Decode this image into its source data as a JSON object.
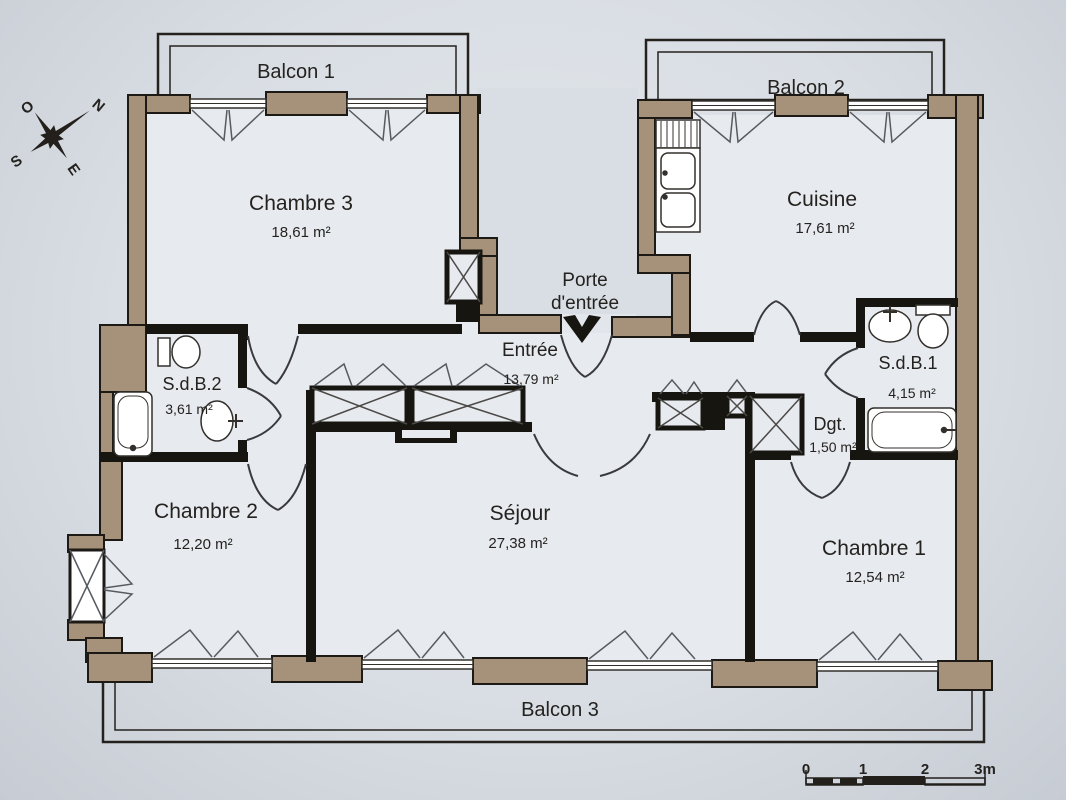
{
  "plan": {
    "balconies": {
      "b1": "Balcon 1",
      "b2": "Balcon 2",
      "b3": "Balcon 3"
    },
    "rooms": {
      "chambre3": {
        "name": "Chambre 3",
        "area": "18,61 m²"
      },
      "cuisine": {
        "name": "Cuisine",
        "area": "17,61 m²"
      },
      "entree": {
        "name": "Entrée",
        "area": "13,79 m²"
      },
      "sdb2": {
        "name": "S.d.B.2",
        "area": "3,61 m²"
      },
      "sdb1": {
        "name": "S.d.B.1",
        "area": "4,15 m²"
      },
      "dgt": {
        "name": "Dgt.",
        "area": "1,50 m²"
      },
      "chambre2": {
        "name": "Chambre 2",
        "area": "12,20 m²"
      },
      "sejour": {
        "name": "Séjour",
        "area": "27,38 m²"
      },
      "chambre1": {
        "name": "Chambre 1",
        "area": "12,54 m²"
      }
    },
    "entrance": {
      "line1": "Porte",
      "line2": "d'entrée"
    },
    "compass": {
      "n": "N",
      "s": "S",
      "e": "E",
      "o": "O"
    },
    "scale_bar": {
      "t0": "0",
      "t1": "1",
      "t2": "2",
      "t3": "3m"
    },
    "colors": {
      "wall": "#a6917a",
      "line": "#1d1a16",
      "paper": "#d9dee4",
      "room": "#e7eaef"
    }
  }
}
